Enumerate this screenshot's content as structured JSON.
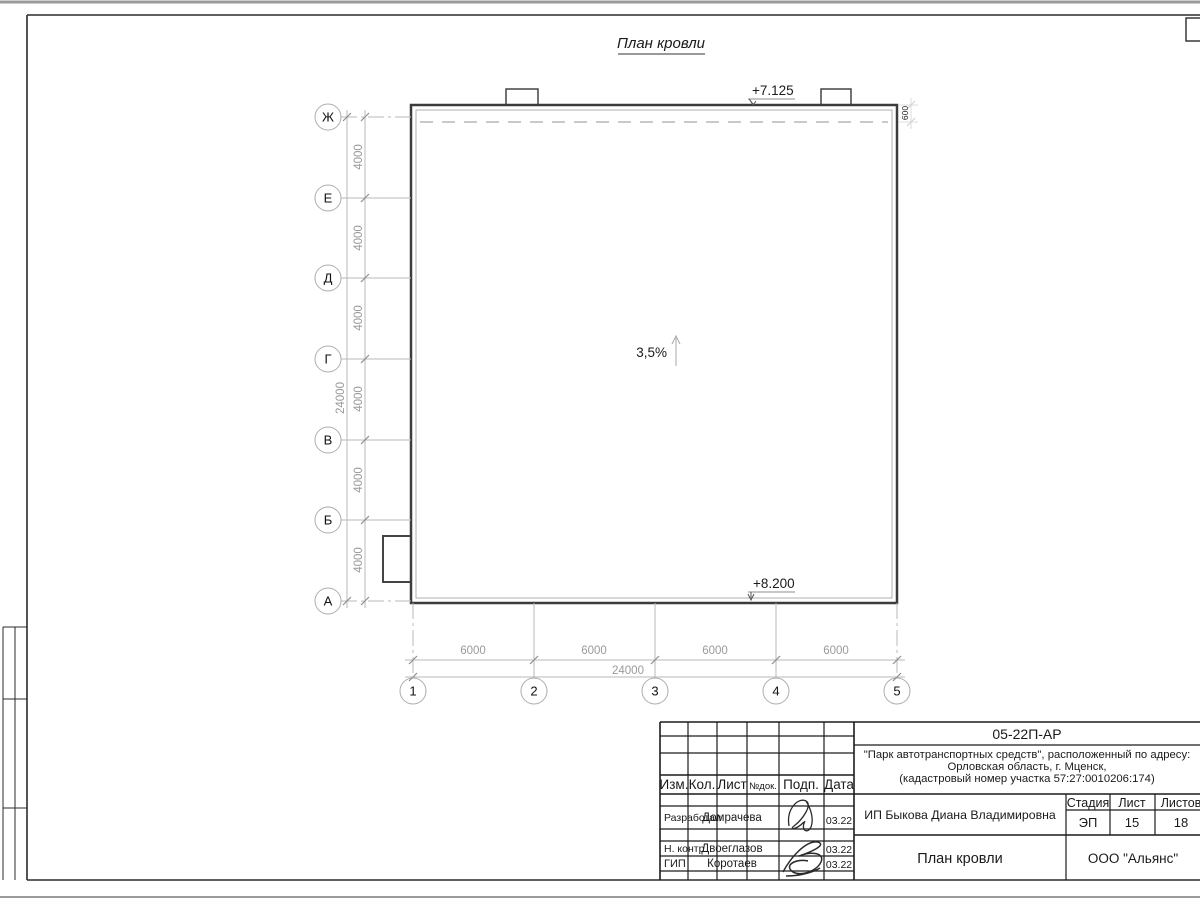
{
  "page": {
    "drawing_title": "План кровли"
  },
  "plan": {
    "slope_label": "3,5%",
    "elevation_top": "+7.125",
    "elevation_bottom": "+8.200",
    "parapet_offset_dim": "600",
    "row_axes": [
      "Ж",
      "Е",
      "Д",
      "Г",
      "В",
      "Б",
      "А"
    ],
    "col_axes": [
      "1",
      "2",
      "3",
      "4",
      "5"
    ],
    "row_spacing_dims": [
      "4000",
      "4000",
      "4000",
      "4000",
      "4000",
      "4000"
    ],
    "row_total_dim": "24000",
    "col_spacing_dims": [
      "6000",
      "6000",
      "6000",
      "6000"
    ],
    "col_total_dim": "24000"
  },
  "titleblock": {
    "doc_number": "05-22П-АР",
    "project_line1": "\"Парк автотранспортных средств\",  расположенный по адресу:",
    "project_line2": "Орловская область, г. Мценск,",
    "project_line3": "(кадастровый номер участка 57:27:0010206:174)",
    "client": "ИП Быкова Диана Владимировна",
    "sheet_title": "План кровли",
    "company": "ООО \"Альянс\"",
    "stage_label": "Стадия",
    "sheet_label": "Лист",
    "sheets_label": "Листов",
    "stage_value": "ЭП",
    "sheet_value": "15",
    "sheets_value": "18",
    "col_headers": [
      "Изм.",
      "Кол.",
      "Лист",
      "№док.",
      "Подп.",
      "Дата"
    ],
    "rows": [
      {
        "role": "Разработал",
        "name": "Домрачева",
        "date": "03.22"
      },
      {
        "role": "Н. контр.",
        "name": "Двоеглазов",
        "date": "03.22"
      },
      {
        "role": "ГИП",
        "name": "Коротаев",
        "date": "03.22"
      }
    ]
  },
  "colors": {
    "line_dark": "#3c3c3c",
    "line_light": "#b8b8b8",
    "dim_text": "#9a9a9a"
  }
}
